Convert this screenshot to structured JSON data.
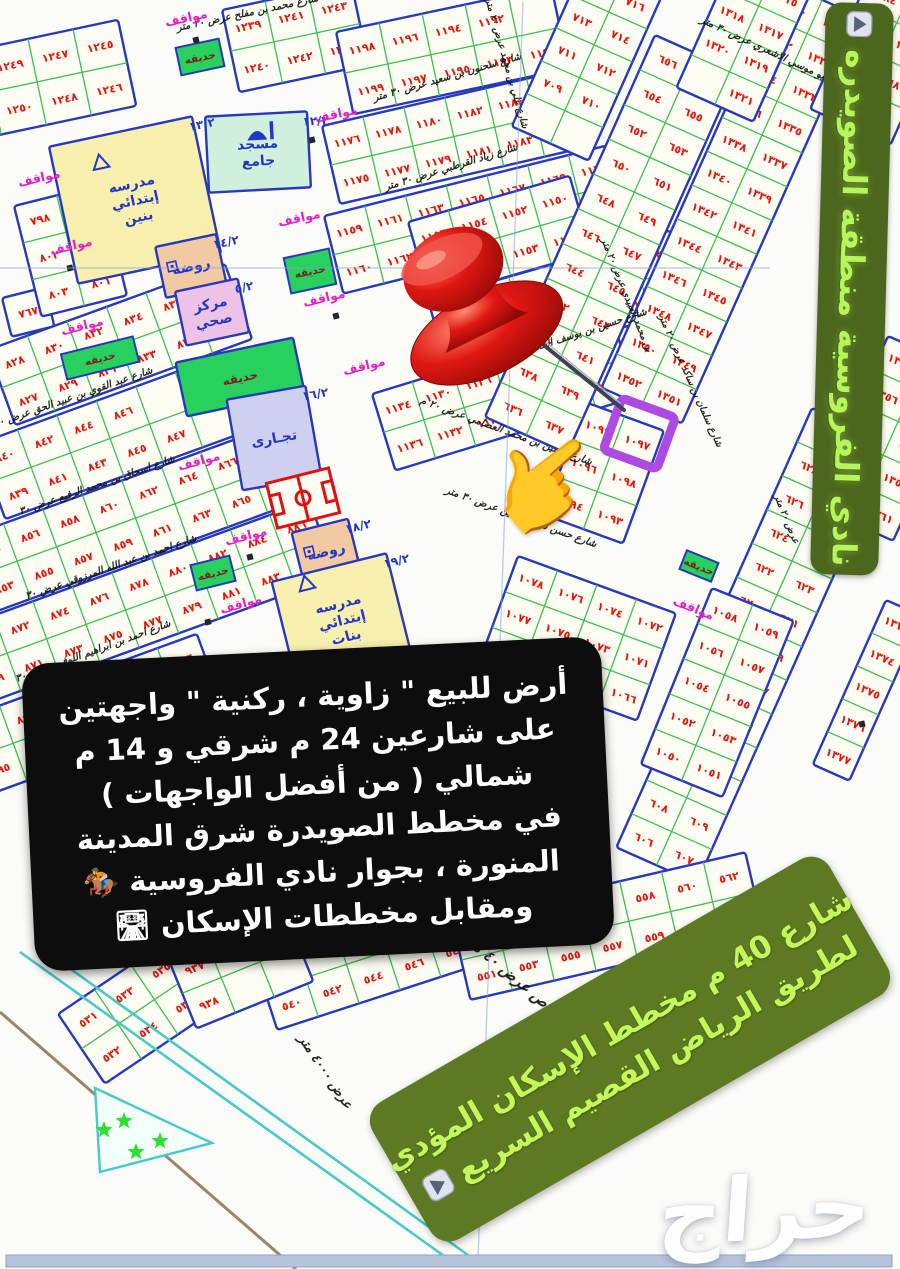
{
  "overlays": {
    "side_banner": {
      "text": "نادي الفروسية منطقة الصويدره",
      "icon": "play-button"
    },
    "ad_box": {
      "lines": [
        "أرض للبيع \" زاوية ، ركنية \" واجهتين",
        "على شارعين 24 م شرقي و 14 م",
        "شمالي ( من أفضل الواجهات )",
        "في مخطط الصويدرة شرق المدينة",
        "المنورة ، بجوار نادي الفروسية 🏇",
        "ومقابل مخططات الإسكان 🛣"
      ]
    },
    "road_banner": {
      "lines": [
        "شارع 40 م مخطط الإسكان المؤدي",
        "لطريق الرياض القصيم السريع"
      ],
      "icon": "play-button"
    },
    "watermark": "حراج",
    "pointer_icon": "👉",
    "pin_icon": "red-pushpin",
    "highlighted_plot": "١٠٩٧"
  },
  "colors": {
    "purple_highlight": "#ab4be4",
    "pin_red": "#e01712",
    "block_border": "#2838bd",
    "plot_line": "#3bbf52",
    "plot_fill": "#fdfdf3",
    "plot_number": "#e8150f",
    "parking_label": "#e81ec8",
    "garden_fill": "#28d05e",
    "garden_label": "#7c1f1f",
    "facility_label": "#2336c6",
    "street_label": "#141414",
    "stadium_red": "#e01010",
    "road_teal": "#49c8c8",
    "bottom_bar": "#b7c3dc",
    "banner_bg": "#4b661d",
    "banner_text": "#b6f65b",
    "road_banner_bg": "#5d7a23",
    "road_banner_text": "#c3f75a"
  },
  "map": {
    "labels": {
      "parking": "مواقف",
      "garden": "حديقه"
    },
    "strips": [
      {
        "x": -62,
        "y": 58,
        "r": -12,
        "cols": 4,
        "rows": 2,
        "cw": 46,
        "ch": 44,
        "nums": [
          1251,
          1249,
          1247,
          1245,
          1252,
          1250,
          1248,
          1246
        ]
      },
      {
        "x": 222,
        "y": 10,
        "r": -12,
        "cols": 3,
        "rows": 2,
        "cw": 44,
        "ch": 42,
        "nums": [
          1239,
          1241,
          1243,
          1240,
          1242,
          1244
        ]
      },
      {
        "x": 2,
        "y": 298,
        "r": -14,
        "cols": 1,
        "rows": 1,
        "cw": 44,
        "ch": 40,
        "nums": [
          767
        ]
      },
      {
        "x": 14,
        "y": 206,
        "r": -14,
        "cols": 2,
        "rows": 3,
        "cw": 44,
        "ch": 38,
        "nums": [
          798,
          799,
          802,
          800,
          803,
          801
        ]
      },
      {
        "x": -12,
        "y": 350,
        "r": -20,
        "cols": 6,
        "rows": 2,
        "cw": 42,
        "ch": 40,
        "nums": [
          828,
          830,
          832,
          834,
          836,
          838,
          827,
          829,
          831,
          833,
          835,
          837
        ]
      },
      {
        "x": -22,
        "y": 444,
        "r": -20,
        "cols": 6,
        "rows": 2,
        "cw": 42,
        "ch": 40,
        "nums": [
          840,
          842,
          844,
          846,
          null,
          null,
          839,
          841,
          843,
          845,
          847,
          null
        ]
      },
      {
        "x": -36,
        "y": 538,
        "r": -20,
        "cols": 8,
        "rows": 2,
        "cw": 42,
        "ch": 40,
        "nums": [
          854,
          856,
          858,
          860,
          862,
          864,
          866,
          868,
          853,
          855,
          857,
          859,
          861,
          863,
          865,
          867
        ]
      },
      {
        "x": -46,
        "y": 630,
        "r": -20,
        "cols": 9,
        "rows": 2,
        "cw": 42,
        "ch": 40,
        "nums": [
          870,
          872,
          874,
          876,
          878,
          880,
          882,
          884,
          886,
          869,
          871,
          873,
          875,
          877,
          879,
          881,
          883,
          885
        ]
      },
      {
        "x": -40,
        "y": 720,
        "r": -20,
        "cols": 6,
        "rows": 2,
        "cw": 42,
        "ch": 40,
        "nums": [
          896,
          898,
          900,
          902,
          904,
          906,
          895,
          897,
          899,
          901,
          903,
          905
        ]
      },
      {
        "x": 336,
        "y": 32,
        "r": -12,
        "cols": 5,
        "rows": 2,
        "cw": 44,
        "ch": 42,
        "nums": [
          1198,
          1196,
          1194,
          1192,
          null,
          1199,
          1197,
          1195,
          1193,
          1191
        ]
      },
      {
        "x": 322,
        "y": 126,
        "r": -13,
        "cols": 6,
        "rows": 2,
        "cw": 42,
        "ch": 40,
        "nums": [
          1176,
          1178,
          1180,
          1182,
          1184,
          1186,
          1175,
          1177,
          1179,
          1181,
          1183,
          1185
        ]
      },
      {
        "x": 324,
        "y": 216,
        "r": -14,
        "cols": 8,
        "rows": 2,
        "cw": 42,
        "ch": 40,
        "nums": [
          1159,
          1161,
          1163,
          1165,
          1167,
          1169,
          1171,
          1173,
          1160,
          1162,
          1164,
          1166,
          1168,
          1170,
          1172,
          1174
        ]
      },
      {
        "x": 408,
        "y": 222,
        "r": -16,
        "cols": 4,
        "rows": 2,
        "cw": 42,
        "ch": 40,
        "nums": [
          1156,
          1154,
          1152,
          1150,
          1157,
          1155,
          1153,
          1151
        ]
      },
      {
        "x": 428,
        "y": 300,
        "r": -16,
        "cols": 6,
        "rows": 2,
        "cw": 42,
        "ch": 40,
        "nums": [
          1148,
          1146,
          1144,
          1142,
          1140,
          1138,
          1149,
          1147,
          1145,
          1143,
          1141,
          1139
        ]
      },
      {
        "x": 372,
        "y": 394,
        "r": -17,
        "cols": 6,
        "rows": 2,
        "cw": 42,
        "ch": 40,
        "nums": [
          1134,
          1130,
          1126,
          1122,
          1118,
          1114,
          1136,
          1132,
          1128,
          1124,
          1120,
          1116
        ]
      },
      {
        "x": 585,
        "y": 402,
        "r": 20,
        "cols": 2,
        "rows": 3,
        "cw": 42,
        "ch": 40,
        "nums": [
          1099,
          1097,
          1096,
          1098,
          1094,
          1093
        ]
      },
      {
        "x": 655,
        "y": 35,
        "r": 24,
        "cols": 2,
        "rows": 11,
        "cw": 45,
        "ch": 38,
        "nums": [
          656,
          657,
          654,
          655,
          652,
          653,
          650,
          651,
          648,
          649,
          646,
          647,
          644,
          645,
          642,
          643,
          640,
          641,
          638,
          639,
          636,
          637
        ]
      },
      {
        "x": 782,
        "y": -18,
        "r": 24,
        "cols": 2,
        "rows": 12,
        "cw": 44,
        "ch": 37,
        "nums": [
          1330,
          1329,
          1332,
          1331,
          1334,
          1333,
          1336,
          1335,
          1338,
          1337,
          1340,
          1339,
          1342,
          1341,
          1344,
          1343,
          1346,
          1345,
          1348,
          1347,
          1350,
          1349,
          1352,
          1351
        ]
      },
      {
        "x": 872,
        "y": -30,
        "r": 24,
        "cols": 2,
        "rows": 4,
        "cw": 44,
        "ch": 38,
        "nums": [
          2684,
          2683,
          2686,
          2685,
          2688,
          2687,
          null,
          2689
        ]
      },
      {
        "x": 735,
        "y": -44,
        "r": 24,
        "cols": 2,
        "rows": 4,
        "cw": 42,
        "ch": 36,
        "nums": [
          1316,
          1315,
          1318,
          1317,
          1320,
          1319,
          null,
          1321
        ]
      },
      {
        "x": 585,
        "y": -38,
        "r": 24,
        "cols": 2,
        "rows": 5,
        "cw": 42,
        "ch": 36,
        "nums": [
          715,
          716,
          713,
          714,
          711,
          712,
          709,
          710,
          null,
          null
        ]
      },
      {
        "x": 812,
        "y": 408,
        "r": 24,
        "cols": 2,
        "rows": 13,
        "cw": 44,
        "ch": 37,
        "nums": [
          630,
          631,
          628,
          629,
          626,
          627,
          624,
          625,
          622,
          623,
          620,
          621,
          618,
          619,
          616,
          617,
          614,
          615,
          612,
          613,
          610,
          611,
          608,
          609,
          606,
          607
        ]
      },
      {
        "x": 712,
        "y": 588,
        "r": 22,
        "cols": 2,
        "rows": 5,
        "cw": 44,
        "ch": 38,
        "nums": [
          1058,
          1059,
          1056,
          1057,
          1054,
          1055,
          1052,
          1053,
          1050,
          1051
        ]
      },
      {
        "x": 518,
        "y": 556,
        "r": 20,
        "cols": 4,
        "rows": 3,
        "cw": 42,
        "ch": 38,
        "nums": [
          1078,
          1076,
          1074,
          1072,
          1077,
          1075,
          1073,
          1071,
          null,
          1070,
          1068,
          1066
        ]
      },
      {
        "x": 888,
        "y": 336,
        "r": 24,
        "cols": 2,
        "rows": 5,
        "cw": 44,
        "ch": 37,
        "nums": [
          1354,
          1353,
          1356,
          1355,
          1358,
          1357,
          1360,
          1359,
          null,
          1361
        ]
      },
      {
        "x": 886,
        "y": 600,
        "r": 24,
        "cols": 1,
        "rows": 5,
        "cw": 40,
        "ch": 36,
        "nums": [
          1373,
          1374,
          1375,
          1376,
          1377
        ]
      },
      {
        "x": 58,
        "y": 1014,
        "r": -34,
        "cols": 5,
        "rows": 2,
        "cw": 44,
        "ch": 42,
        "nums": [
          531,
          533,
          535,
          537,
          539,
          532,
          534,
          536,
          538,
          null
        ]
      },
      {
        "x": 252,
        "y": 952,
        "r": -18,
        "cols": 5,
        "rows": 2,
        "cw": 43,
        "ch": 41,
        "nums": [
          541,
          543,
          545,
          547,
          549,
          540,
          542,
          544,
          546,
          548
        ]
      },
      {
        "x": 452,
        "y": 920,
        "r": -13,
        "cols": 7,
        "rows": 2,
        "cw": 43,
        "ch": 41,
        "nums": [
          550,
          552,
          554,
          556,
          558,
          560,
          562,
          551,
          553,
          555,
          557,
          559,
          561
        ]
      },
      {
        "x": 168,
        "y": 958,
        "r": -22,
        "cols": 3,
        "rows": 2,
        "cw": 42,
        "ch": 38,
        "nums": [
          937,
          939,
          940,
          938,
          null,
          null
        ]
      }
    ],
    "facilities": [
      {
        "cx": 258,
        "cy": 152,
        "w": 102,
        "h": 76,
        "r": -3,
        "fill": "#cff0dc",
        "label": [
          "مسجد",
          "جامع"
        ],
        "code": "١٢/٢",
        "icon": "mosque",
        "name": "mosque"
      },
      {
        "cx": 135,
        "cy": 200,
        "w": 146,
        "h": 140,
        "r": -12,
        "fill": "#f6efad",
        "label": [
          "مدرسه",
          "إبتدائي",
          "بنين"
        ],
        "code": "١٣/٢",
        "icon": "tri",
        "name": "boys-school"
      },
      {
        "cx": 191,
        "cy": 266,
        "w": 62,
        "h": 52,
        "r": -12,
        "fill": "#f2c9a2",
        "label": [
          "روضه"
        ],
        "code": "١٤/٢",
        "icon": "sq",
        "name": "kindergarten-14"
      },
      {
        "cx": 212,
        "cy": 312,
        "w": 64,
        "h": 55,
        "r": -12,
        "fill": "#eec2e6",
        "label": [
          "مركز",
          "صحي"
        ],
        "code": "٥/٢",
        "name": "health-center"
      },
      {
        "cx": 240,
        "cy": 377,
        "w": 120,
        "h": 55,
        "r": -12,
        "fill": "#28d05e",
        "label": [
          "حديقه"
        ],
        "lblc": "#7c1f1f",
        "name": "park"
      },
      {
        "cx": 274,
        "cy": 438,
        "w": 80,
        "h": 92,
        "r": -10,
        "fill": "#cfcfef",
        "label": [
          "تجـارى"
        ],
        "code": "١٦/٢",
        "name": "commercial"
      },
      {
        "cx": 303,
        "cy": 498,
        "w": 74,
        "h": 56,
        "r": -14,
        "icon": "stadium",
        "name": "stadium"
      },
      {
        "cx": 326,
        "cy": 551,
        "w": 58,
        "h": 52,
        "r": -14,
        "fill": "#f2c9a2",
        "label": [
          "روضه"
        ],
        "code": "١٨/٢",
        "icon": "sq",
        "name": "kindergarten-18"
      },
      {
        "cx": 342,
        "cy": 620,
        "w": 118,
        "h": 108,
        "r": -14,
        "fill": "#f6efad",
        "label": [
          "مدرسه",
          "إبتدائي",
          "بنات"
        ],
        "code": "١٩/٢",
        "icon": "tri",
        "name": "girls-school"
      }
    ],
    "streets": [
      {
        "t": "شارع محمد بن مفلح عرض ٣٠ متر",
        "x": 248,
        "y": 16,
        "r": -12,
        "s": 10
      },
      {
        "t": "شارع سحنون بن سعيد عرض ٣٠ متر",
        "x": 448,
        "y": 80,
        "r": -16,
        "s": 10
      },
      {
        "t": "شارع زياد القرطبي عرض ٣٠ متر",
        "x": 452,
        "y": 170,
        "r": -17,
        "s": 10
      },
      {
        "t": "شارع علي بن محمد عرض ٢٠ متر",
        "x": 504,
        "y": 64,
        "r": 74,
        "s": 9.5
      },
      {
        "t": "شارع علي بن ابو موسي الاشعري عرض ٣٠ متر",
        "x": 790,
        "y": 64,
        "r": 25,
        "s": 10
      },
      {
        "t": "شارع حسين بن يوسف الخلاطي عرض ٣٠ متر",
        "x": 556,
        "y": 344,
        "r": -18,
        "s": 10
      },
      {
        "t": "شارع حسين بن محمد العصامي عرض ٢٠ م",
        "x": 505,
        "y": 434,
        "r": 20,
        "s": 10
      },
      {
        "t": "شارع حسن شاكر الامين عرض ٣٠ متر",
        "x": 520,
        "y": 520,
        "r": 20,
        "s": 10
      },
      {
        "t": "شارع سلمان بن ساكد عرض ٢٠ متر",
        "x": 688,
        "y": 382,
        "r": 66,
        "s": 9.5
      },
      {
        "t": "شارع عبد القوي بن عبيد الحق عرض ٣٠",
        "x": 74,
        "y": 400,
        "r": -19,
        "s": 10
      },
      {
        "t": "شارع اسحاق بن محمد الرفيع عرض ٣٠",
        "x": 98,
        "y": 488,
        "r": -19,
        "s": 10
      },
      {
        "t": "شارع احمد بن عبد الله المرزوقي عرض ٣٠",
        "x": 112,
        "y": 570,
        "r": -19,
        "s": 10
      },
      {
        "t": "شارع احمد بن ابراهيم اللوفي عرض ٣٠",
        "x": 94,
        "y": 654,
        "r": -20,
        "s": 10
      },
      {
        "t": "شارع عثمان بن ابي العاص عرض ٤٠ متر",
        "x": 560,
        "y": 1022,
        "r": 40,
        "s": 15
      },
      {
        "t": "عرض ٤٠٠٠ متر",
        "x": 322,
        "y": 1074,
        "r": 56,
        "s": 13
      },
      {
        "t": "بن محمد العبيدي عرض ٢٠ متر",
        "x": 624,
        "y": 296,
        "r": 68,
        "s": 9.5
      },
      {
        "t": "عرض ٢٠ متر",
        "x": 784,
        "y": 520,
        "r": 68,
        "s": 9.5
      }
    ],
    "parkings": [
      [
        187,
        22,
        -12
      ],
      [
        337,
        118,
        -12
      ],
      [
        300,
        222,
        -12
      ],
      [
        325,
        302,
        -13
      ],
      [
        40,
        182,
        -13
      ],
      [
        72,
        250,
        -13
      ],
      [
        83,
        330,
        -14
      ],
      [
        365,
        370,
        -14
      ],
      [
        200,
        465,
        -15
      ],
      [
        247,
        540,
        -15
      ],
      [
        242,
        608,
        -16
      ],
      [
        692,
        612,
        22
      ]
    ],
    "gardens": [
      [
        200,
        57,
        44,
        28,
        -12
      ],
      [
        310,
        271,
        46,
        36,
        -12
      ],
      [
        100,
        358,
        74,
        26,
        -14
      ],
      [
        213,
        573,
        40,
        26,
        -14
      ],
      [
        699,
        566,
        34,
        20,
        22
      ]
    ],
    "dots": [
      [
        196,
        40
      ],
      [
        312,
        140
      ],
      [
        70,
        268
      ],
      [
        336,
        316
      ],
      [
        250,
        557
      ],
      [
        208,
        622
      ],
      [
        470,
        940
      ],
      [
        862,
        724
      ]
    ],
    "stars": [
      [
        124,
        1121
      ],
      [
        160,
        1141
      ],
      [
        136,
        1152
      ],
      [
        104,
        1130
      ]
    ]
  }
}
